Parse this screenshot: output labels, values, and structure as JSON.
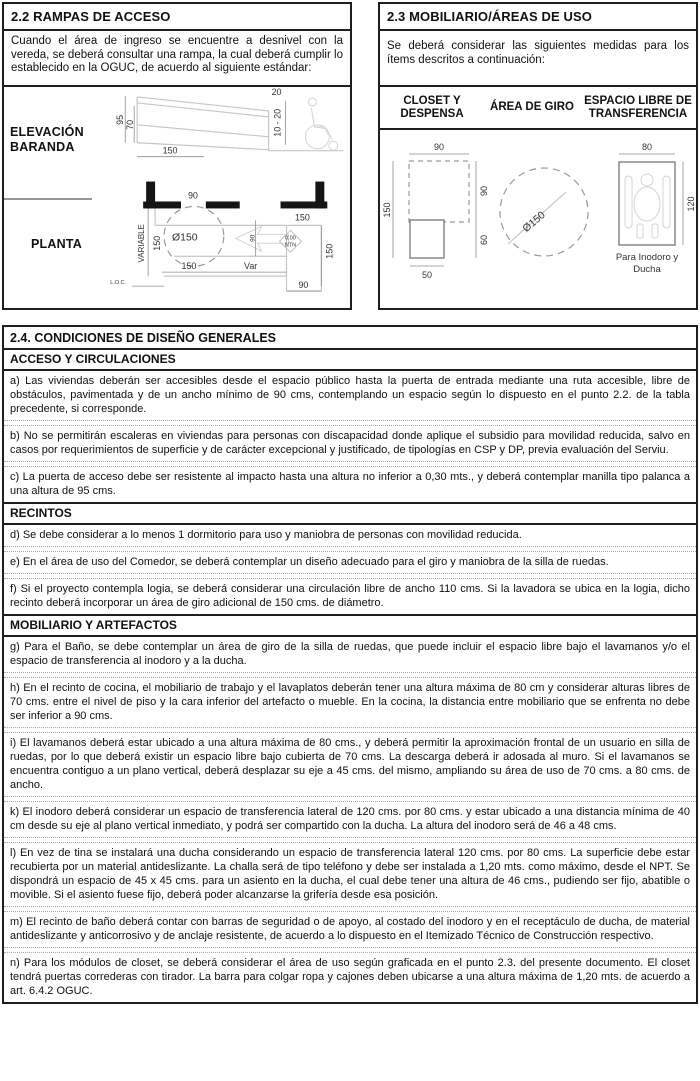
{
  "rampas": {
    "title": "2.2 RAMPAS DE ACCESO",
    "intro": "Cuando el área de ingreso se encuentre a desnivel con la vereda, se deberá consultar una rampa, la cual deberá cumplir lo establecido en la OGUC, de acuerdo al siguiente estándar:",
    "elevacion_label_line1": "ELEVACIÓN",
    "elevacion_label_line2": "BARANDA",
    "planta_label": "PLANTA",
    "elev_dims": {
      "h95": "95",
      "h70": "70",
      "w150": "150",
      "top20": "20",
      "step": "10 - 20"
    },
    "planta_dims": {
      "door90": "90",
      "right150": "150",
      "variable": "VARIABLE",
      "left150": "150",
      "circle": "Ø150",
      "bottom150": "150",
      "var": "Var",
      "ramp90": "90",
      "level_value": "0.00",
      "level_ref": "NTN",
      "vert150": "150",
      "br90": "90",
      "loc": "L.O.C."
    }
  },
  "mobiliario": {
    "title": "2.3 MOBILIARIO/ÁREAS DE USO",
    "intro": "Se deberá considerar las siguientes medidas para los ítems descritos a continuación:",
    "col1": "CLOSET Y DESPENSA",
    "col2": "ÁREA DE GIRO",
    "col3": "ESPACIO LIBRE DE TRANSFERENCIA",
    "closet_dims": {
      "top90": "90",
      "left150": "150",
      "right90": "90",
      "right60": "60",
      "bottom50": "50"
    },
    "giro_dims": {
      "circle": "Ø150"
    },
    "transfer_dims": {
      "top80": "80",
      "right120": "120",
      "caption1": "Para Inodoro y",
      "caption2": "Ducha"
    }
  },
  "sec24": {
    "title": "2.4. CONDICIONES DE DISEÑO GENERALES",
    "rows": [
      {
        "kind": "header",
        "text": "ACCESO Y CIRCULACIONES"
      },
      {
        "kind": "para",
        "text": "a) Las viviendas deberán ser accesibles desde el espacio público hasta la puerta de entrada mediante una ruta accesible, libre de obstáculos, pavimentada y de un ancho mínimo de 90 cms, contemplando un espacio según lo dispuesto en el punto 2.2. de la tabla precedente, si corresponde."
      },
      {
        "kind": "para",
        "text": "b) No se permitirán escaleras en viviendas para personas con discapacidad donde aplique el subsidio para movilidad reducida, salvo en casos por requerimientos de superficie y de carácter excepcional y justificado, de tipologías en CSP y DP, previa evaluación del Serviu."
      },
      {
        "kind": "para",
        "text": "c) La puerta de acceso debe ser resistente al impacto hasta una altura no inferior a 0,30 mts., y deberá contemplar manilla tipo palanca a una altura de 95 cms."
      },
      {
        "kind": "header",
        "text": "RECINTOS"
      },
      {
        "kind": "para",
        "text": "d) Se debe considerar a lo menos 1 dormitorio para uso y maniobra de personas con movilidad reducida."
      },
      {
        "kind": "para",
        "text": "e) En el área de uso del Comedor, se deberá contemplar un diseño adecuado para el giro y maniobra de la silla de ruedas."
      },
      {
        "kind": "para",
        "text": "f) Si el proyecto contempla logia, se deberá considerar una circulación libre de ancho 110 cms. Si la lavadora se ubica en la logia, dicho recinto deberá incorporar un área de giro adicional de 150 cms. de diámetro."
      },
      {
        "kind": "header",
        "text": "MOBILIARIO Y ARTEFACTOS"
      },
      {
        "kind": "para",
        "text": "g) Para el Baño, se debe contemplar un área de giro de la silla de ruedas, que puede incluir el espacio libre bajo el lavamanos y/o el espacio de transferencia al inodoro y a la ducha."
      },
      {
        "kind": "para",
        "text": "h) En el recinto de cocina, el mobiliario de trabajo y el lavaplatos deberán tener una altura máxima de 80 cm y considerar alturas libres de 70 cms. entre el nivel de piso y la cara inferior del artefacto o mueble. En la cocina, la distancia entre mobiliario que se enfrenta no debe ser inferior a 90 cms."
      },
      {
        "kind": "para",
        "text": "i) El lavamanos deberá estar ubicado a una altura máxima de 80 cms., y deberá permitir la aproximación frontal de un usuario en silla de ruedas, por lo que deberá existir un espacio libre bajo cubierta de 70 cms. La descarga deberá ir adosada al muro. Si el lavamanos se encuentra contiguo a un plano vertical, deberá desplazar su eje a 45 cms. del mismo, ampliando su área de uso de 70 cms. a 80 cms. de ancho."
      },
      {
        "kind": "para",
        "text": "k) El inodoro deberá considerar un espacio de transferencia lateral de 120 cms. por 80 cms. y estar ubicado a una distancia mínima de 40 cm desde su eje al plano vertical inmediato, y podrá ser compartido con la ducha. La altura del inodoro será de 46 a 48 cms."
      },
      {
        "kind": "para",
        "text": "l) En vez de tina se instalará una ducha considerando un espacio de transferencia lateral 120 cms. por 80 cms. La superficie debe estar recubierta por un material antideslizante. La challa será de tipo teléfono y debe ser instalada a 1,20 mts. como máximo, desde el NPT. Se dispondrá un espacio de 45 x 45 cms. para un asiento en la ducha, el cual debe tener una altura de 46 cms., pudiendo ser fijo, abatible o movible. Si el asiento fuese fijo, deberá poder alcanzarse la grifería desde esa posición."
      },
      {
        "kind": "para",
        "text": "m) El recinto de baño deberá contar con barras de seguridad o de apoyo, al costado del inodoro y en el receptáculo de ducha, de material antideslizante y anticorrosivo y de anclaje resistente, de acuerdo a lo dispuesto en el Itemizado Técnico de Construcción respectivo."
      },
      {
        "kind": "para",
        "text": "n) Para los módulos de closet, se deberá considerar el área de uso según graficada en el punto 2.3. del presente documento. El closet tendrá puertas correderas con tirador. La barra para colgar ropa y cajones deben ubicarse a una altura máxima de 1,20 mts. de acuerdo a art. 6.4.2 OGUC."
      }
    ]
  }
}
